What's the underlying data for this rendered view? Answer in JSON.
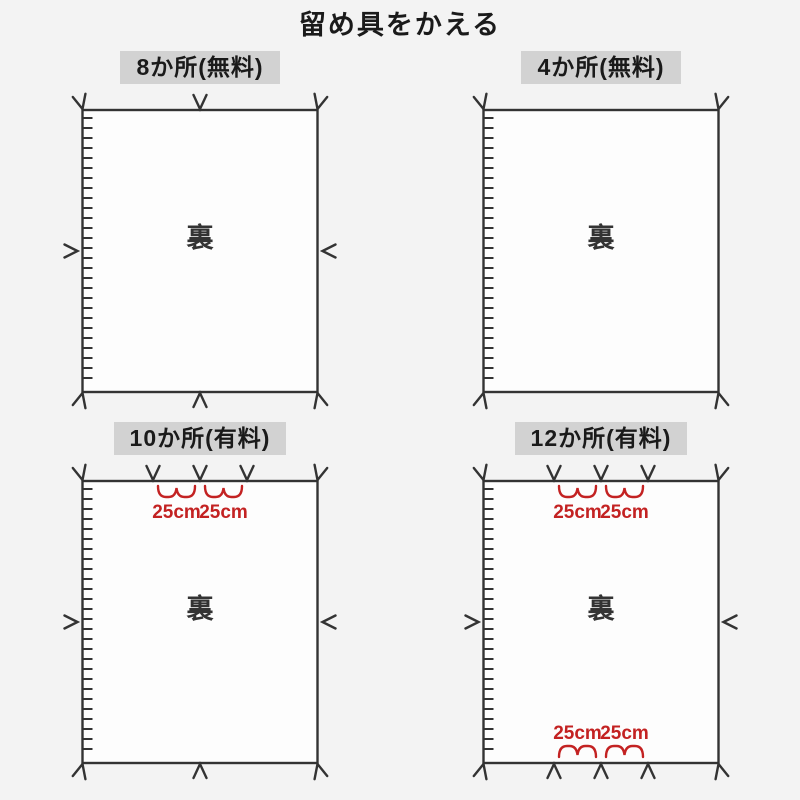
{
  "title": "留め具をかえる",
  "colors": {
    "background": "#f3f3f3",
    "header_background": "#d2d2d2",
    "panel_fill": "#fdfdfd",
    "line": "#333333",
    "measurement_red": "#c32222",
    "text": "#1a1a1a"
  },
  "panels": [
    {
      "key": "8-places-free",
      "label": "8か所(無料)",
      "back_label": "裏",
      "position": "top-left",
      "top_arrows": [
        0,
        0.5,
        1
      ],
      "bottom_arrows": [
        0,
        0.5,
        1
      ],
      "left_arrow": true,
      "right_arrow": true,
      "top_measurements": [],
      "bottom_measurements": []
    },
    {
      "key": "4-places-free",
      "label": "4か所(無料)",
      "back_label": "裏",
      "position": "top-right",
      "top_arrows": [
        0,
        1
      ],
      "bottom_arrows": [
        0,
        1
      ],
      "left_arrow": false,
      "right_arrow": false,
      "top_measurements": [],
      "bottom_measurements": []
    },
    {
      "key": "10-places-paid",
      "label": "10か所(有料)",
      "back_label": "裏",
      "position": "bottom-left",
      "top_arrows": [
        0,
        0.3,
        0.5,
        0.7,
        1
      ],
      "bottom_arrows": [
        0,
        0.5,
        1
      ],
      "left_arrow": true,
      "right_arrow": true,
      "top_measurements": [
        {
          "from": 0.3,
          "to": 0.5,
          "label": "25cm"
        },
        {
          "from": 0.5,
          "to": 0.7,
          "label": "25cm"
        }
      ],
      "bottom_measurements": []
    },
    {
      "key": "12-places-paid",
      "label": "12か所(有料)",
      "back_label": "裏",
      "position": "bottom-right",
      "top_arrows": [
        0,
        0.3,
        0.5,
        0.7,
        1
      ],
      "bottom_arrows": [
        0,
        0.3,
        0.5,
        0.7,
        1
      ],
      "left_arrow": true,
      "right_arrow": true,
      "top_measurements": [
        {
          "from": 0.3,
          "to": 0.5,
          "label": "25cm"
        },
        {
          "from": 0.5,
          "to": 0.7,
          "label": "25cm"
        }
      ],
      "bottom_measurements": [
        {
          "from": 0.3,
          "to": 0.5,
          "label": "25cm"
        },
        {
          "from": 0.5,
          "to": 0.7,
          "label": "25cm"
        }
      ]
    }
  ]
}
